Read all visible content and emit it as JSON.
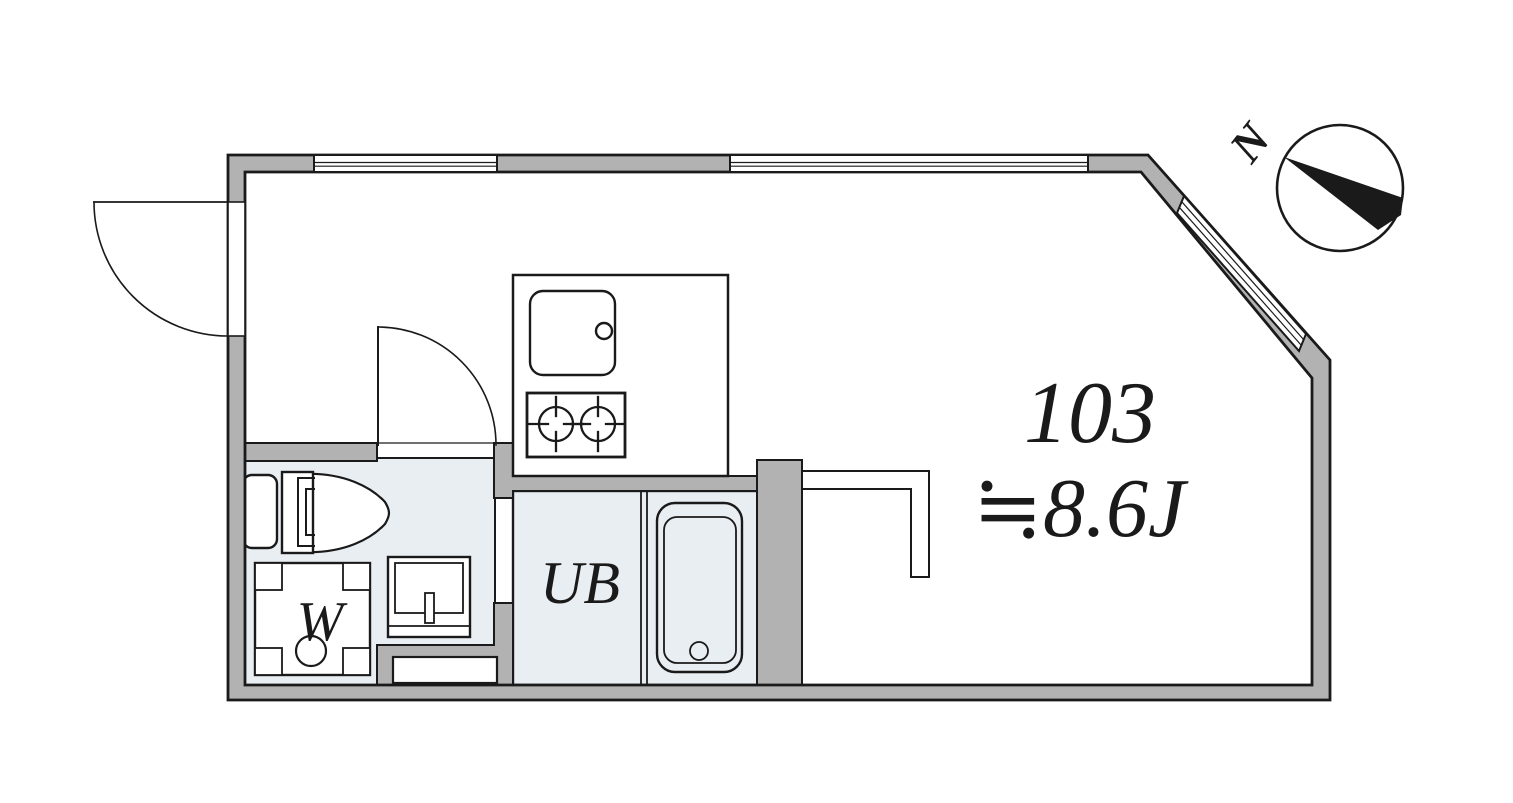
{
  "floor_plan": {
    "unit_number": "103",
    "area_label": "≒8.6J",
    "rooms": {
      "unit_bath_label": "UB",
      "washer_label": "W"
    },
    "compass": {
      "north_label": "N"
    },
    "colors": {
      "wall_fill": "#b2b2b2",
      "wet_area_floor": "#e9eef3",
      "line": "#1a1a1a",
      "background": "#ffffff"
    }
  }
}
